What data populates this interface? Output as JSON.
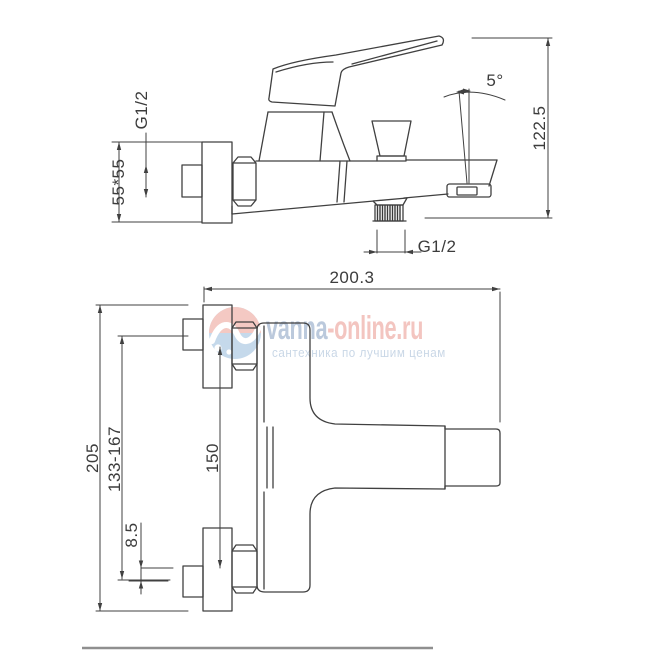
{
  "canvas": {
    "line_color": "#404040",
    "dim_text_color": "#3c3c3c",
    "separator_color": "#8f8f8f"
  },
  "side_view": {
    "dims": {
      "inlet_thread": "G1/2",
      "escutcheon_size": "55*55",
      "overall_height": "122.5",
      "spout_angle": "5°",
      "outlet_thread": "G1/2"
    }
  },
  "front_view": {
    "dims": {
      "overall_length": "200.3",
      "mounting_height": "205",
      "inlet_spacing_range": "133-167",
      "mounting_centers": "150",
      "eccentric_offset": "8.5"
    }
  },
  "watermark": {
    "brand_primary": "vanna",
    "brand_secondary": "-online.ru",
    "tagline": "сантехника по лучшим ценам",
    "brand_primary_color": "#92a9c7",
    "brand_secondary_color": "#eda39b",
    "tagline_color": "#a9bfd8",
    "logo_top_color": "#e98d7f",
    "logo_bottom_color": "#85aed6"
  }
}
